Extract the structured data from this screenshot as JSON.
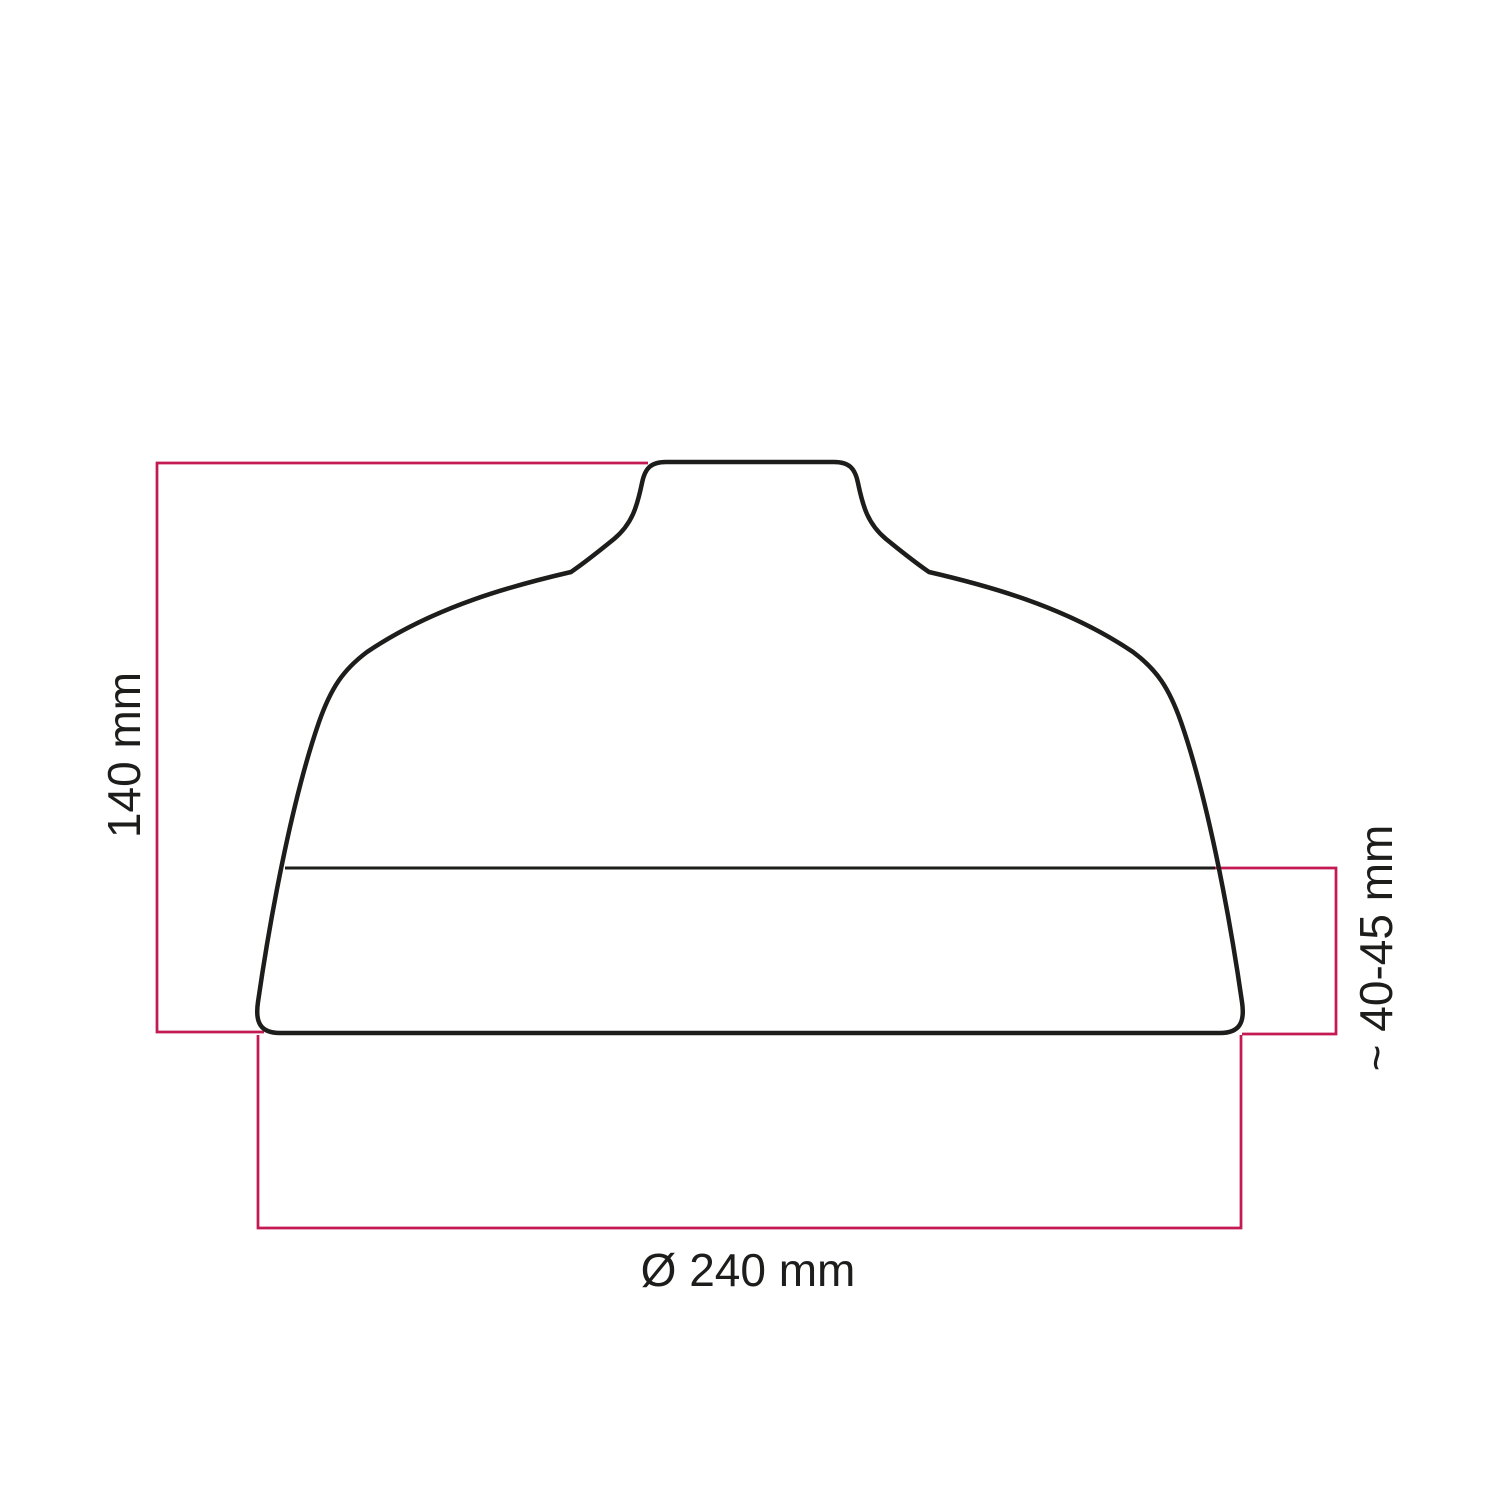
{
  "diagram": {
    "subject": "lampshade-profile-dimension-drawing",
    "labels": {
      "height": "140 mm",
      "band_height": "~ 40-45 mm",
      "diameter": "Ø 240 mm"
    }
  },
  "colors": {
    "accent": "#c41a54",
    "ink": "#1d1d1b",
    "background": "#ffffff"
  }
}
